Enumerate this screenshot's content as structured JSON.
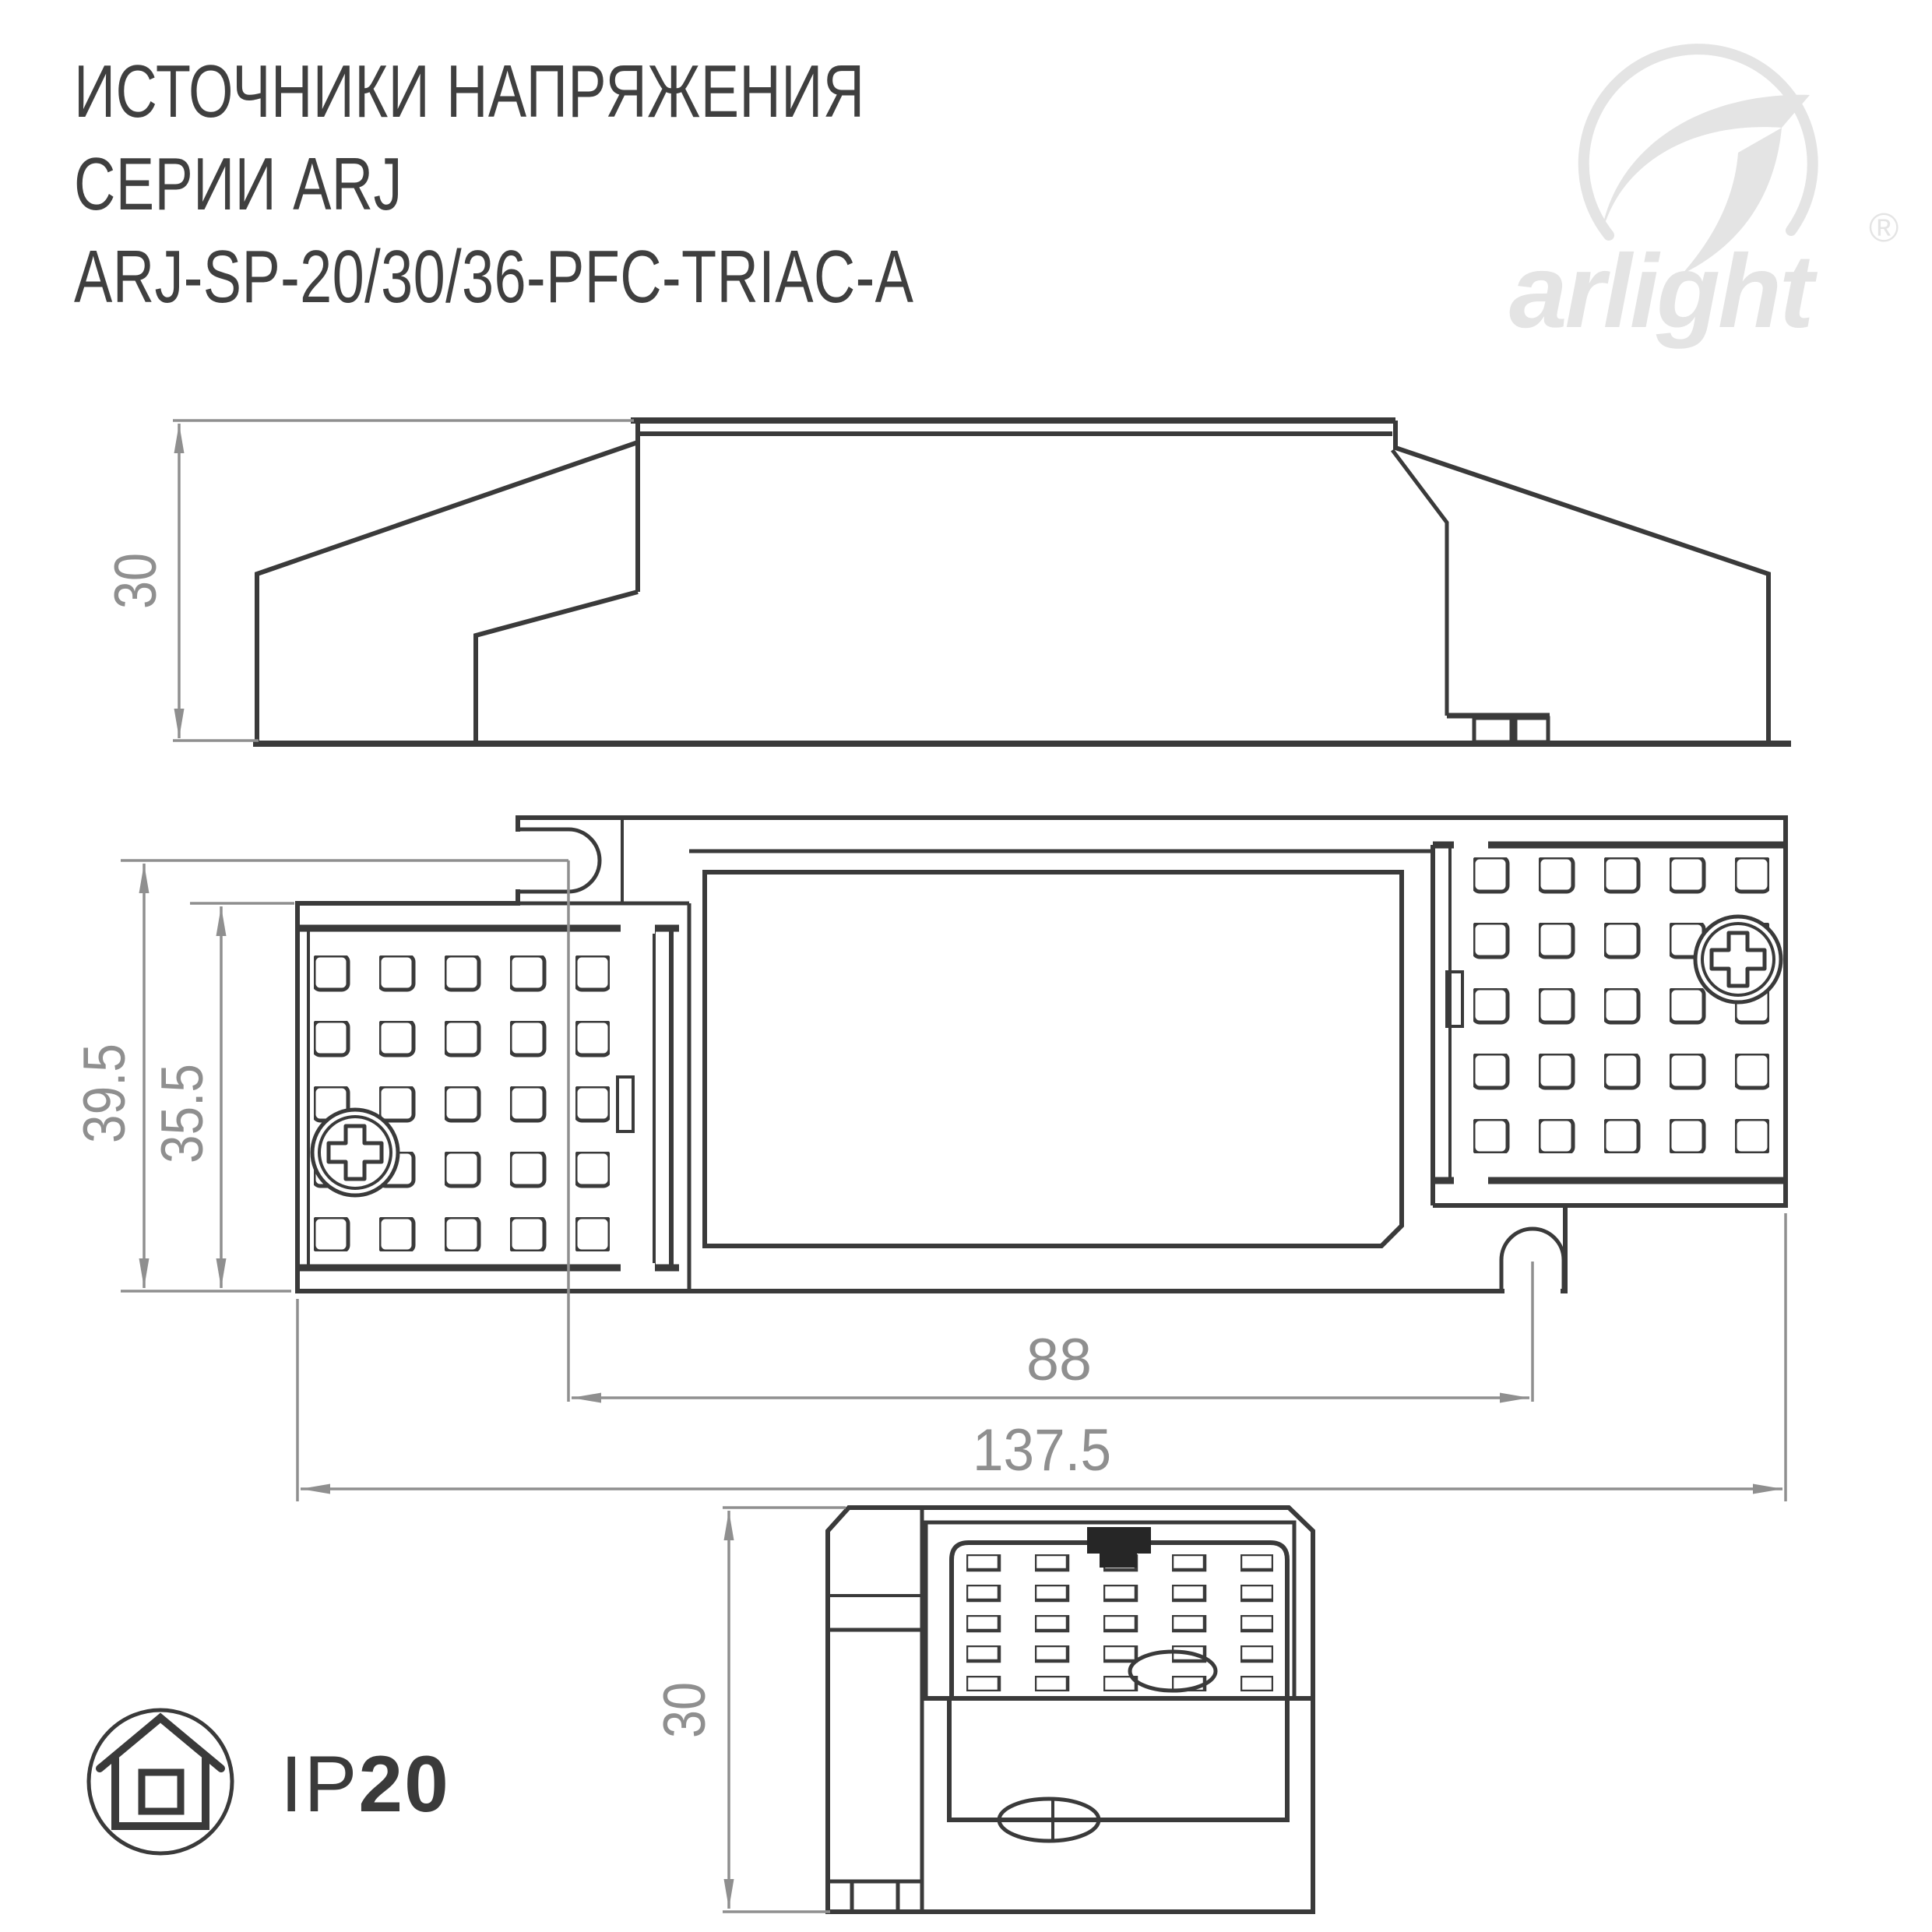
{
  "title": {
    "line1": "ИСТОЧНИКИ НАПРЯЖЕНИЯ",
    "line2": "СЕРИИ ARJ",
    "line3": "ARJ-SP-20/30/36-PFC-TRIAC-A"
  },
  "logo": {
    "brand": "arlight",
    "registered": "®"
  },
  "views": {
    "side_view": {
      "label": "side profile view",
      "dimensions": {
        "height_mm": "30"
      }
    },
    "top_view": {
      "label": "top (plan) view",
      "dimensions": {
        "body_width_mm": "39.5",
        "cover_width_mm": "35.5",
        "slot_spacing_mm": "88",
        "overall_length_mm": "137.5"
      }
    },
    "end_view": {
      "label": "end view",
      "dimensions": {
        "height_mm": "30"
      }
    }
  },
  "badge": {
    "icon": "house-icon",
    "ip_prefix": "IP",
    "ip_value": "20"
  },
  "colors": {
    "drawing_line": "#3a3a3a",
    "dimension_gray": "#8f8f8f",
    "logo_gray": "#e4e4e4",
    "clip_black": "#262626",
    "background": "#ffffff"
  }
}
